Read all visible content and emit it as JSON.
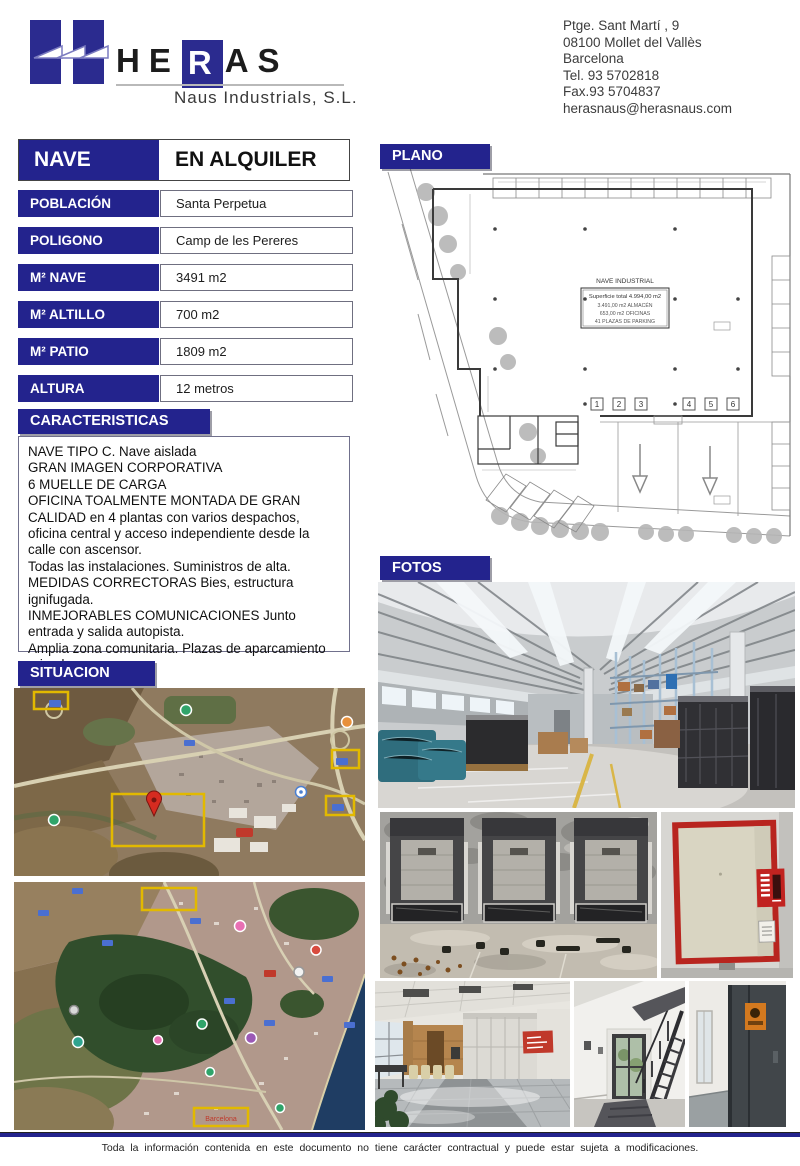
{
  "colors": {
    "navy": "#23238d",
    "accent_red": "#c0392b",
    "map_highlight_yellow": "#e2b900"
  },
  "header": {
    "logo": {
      "word_he": "HE",
      "word_r": "R",
      "word_as": "AS",
      "subtitle": "Naus Industrials, S.L."
    },
    "contact_lines": [
      "Ptge. Sant Martí , 9",
      "08100 Mollet del Vallès",
      "Barcelona",
      "Tel. 93 5702818",
      "Fax.93 5704837",
      "herasnaus@herasnaus.com"
    ]
  },
  "listing": {
    "type_label": "NAVE",
    "status_label": "EN ALQUILER",
    "fields": [
      {
        "label": "POBLACIÓN",
        "value": "Santa Perpetua"
      },
      {
        "label": "POLIGONO",
        "value": "Camp de les Pereres"
      },
      {
        "label": "M² NAVE",
        "value": "3491 m2"
      },
      {
        "label": "M² ALTILLO",
        "value": "700 m2"
      },
      {
        "label": "M² PATIO",
        "value": "1809 m2"
      },
      {
        "label": "ALTURA",
        "value": "12 metros"
      }
    ]
  },
  "caracteristicas": {
    "title": "CARACTERISTICAS",
    "text": "NAVE TIPO C. Nave aislada\nGRAN IMAGEN CORPORATIVA\n6 MUELLE DE CARGA\nOFICINA TOALMENTE MONTADA DE GRAN CALIDAD en 4 plantas con varios despachos, oficina central y acceso independiente desde la calle con ascensor.\nTodas las instalaciones. Suministros de alta.\nMEDIDAS CORRECTORAS Bies, estructura ignifugada.\nINMEJORABLES COMUNICACIONES Junto entrada y salida autopista.\nAmplia zona comunitaria. Plazas de aparcamiento privadas."
  },
  "plano": {
    "title": "PLANO",
    "label_box": {
      "title": "NAVE INDUSTRIAL",
      "line1": "Superficie total 4.994,00 m2",
      "line2": "3.491,00 m2 ALMACÉN",
      "line3": "653,00 m2 OFICINAS",
      "line4": "41 PLAZAS DE PARKING"
    },
    "dock_numbers": [
      "1",
      "2",
      "3",
      "4",
      "5",
      "6"
    ]
  },
  "fotos": {
    "title": "FOTOS"
  },
  "situacion": {
    "title": "SITUACION",
    "map2_label": "Barcelona"
  },
  "footer": {
    "disclaimer": "Toda la información contenida en este documento no tiene carácter contractual y puede estar sujeta a modificaciones."
  }
}
